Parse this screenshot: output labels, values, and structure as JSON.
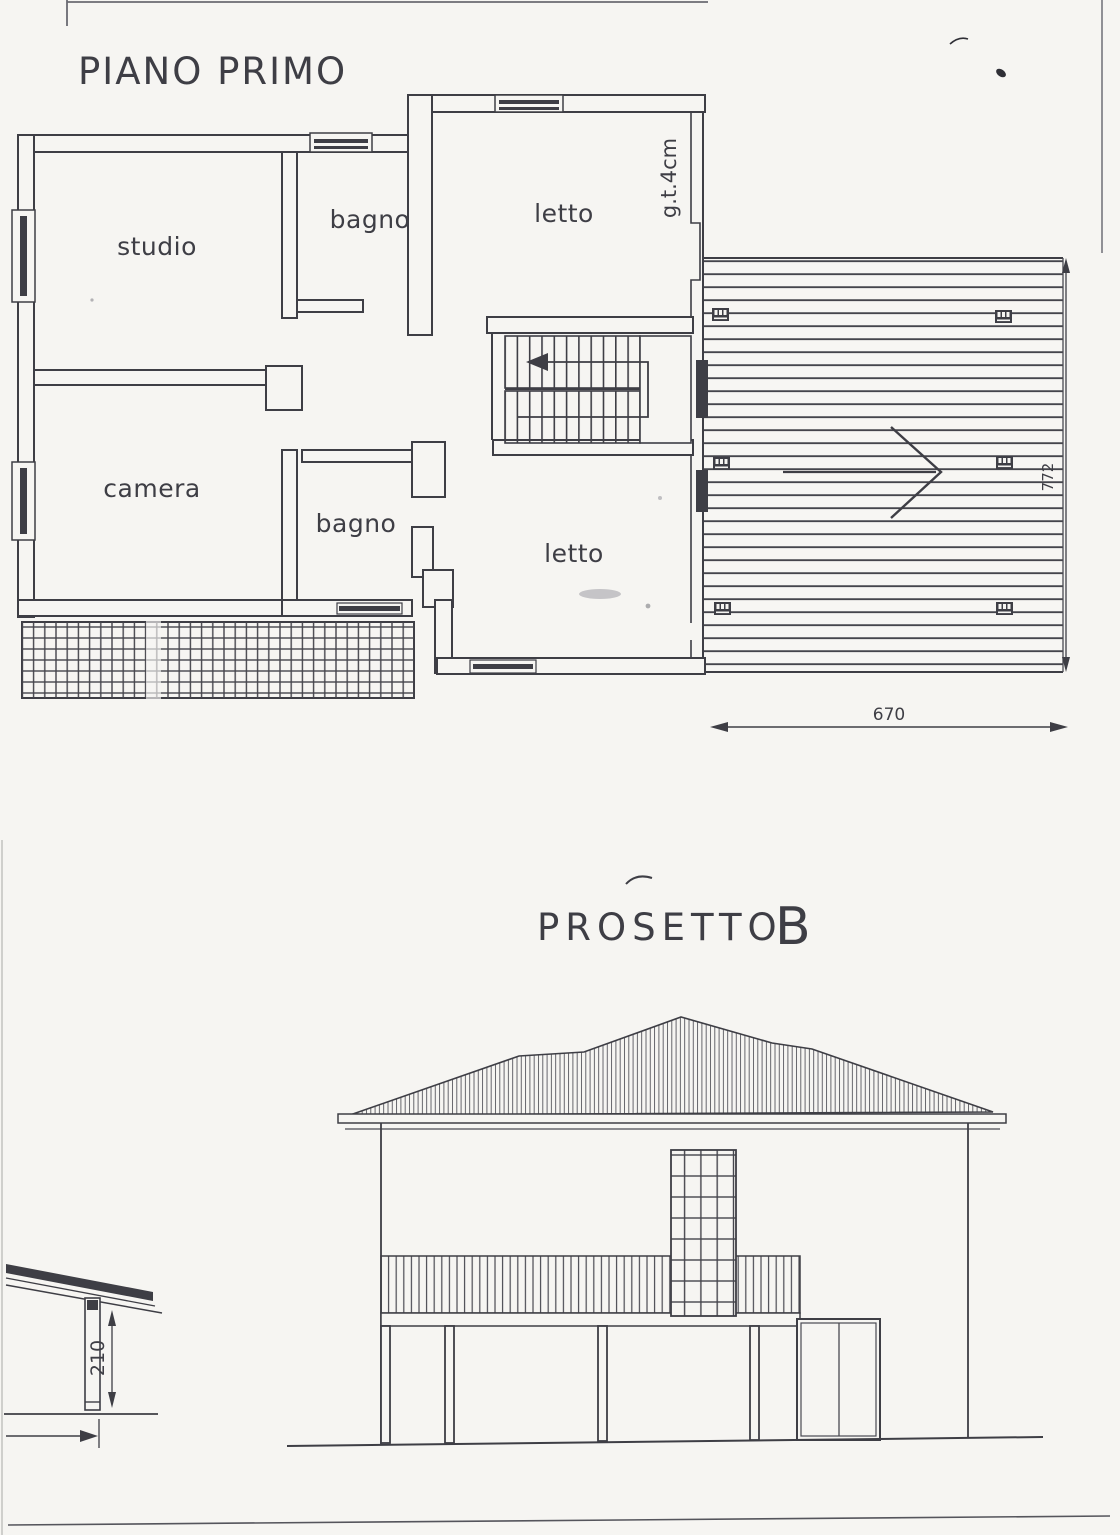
{
  "colors": {
    "paper": "#f6f5f2",
    "ink": "#3e3e45",
    "line_mid": "#55555c",
    "line_light": "#9a9aa0"
  },
  "floor_plan": {
    "title": "PIANO PRIMO",
    "rooms": {
      "studio": "studio",
      "bagno_top": "bagno",
      "letto_top": "letto",
      "camera": "camera",
      "bagno_bottom": "bagno",
      "letto_bottom": "letto"
    },
    "wall_note": "g.t.4cm",
    "dimensions": {
      "deck_width": "670",
      "deck_depth": "772"
    }
  },
  "elevation": {
    "title": "PROSETTO",
    "label": "B"
  },
  "detail": {
    "post_height": "210"
  }
}
